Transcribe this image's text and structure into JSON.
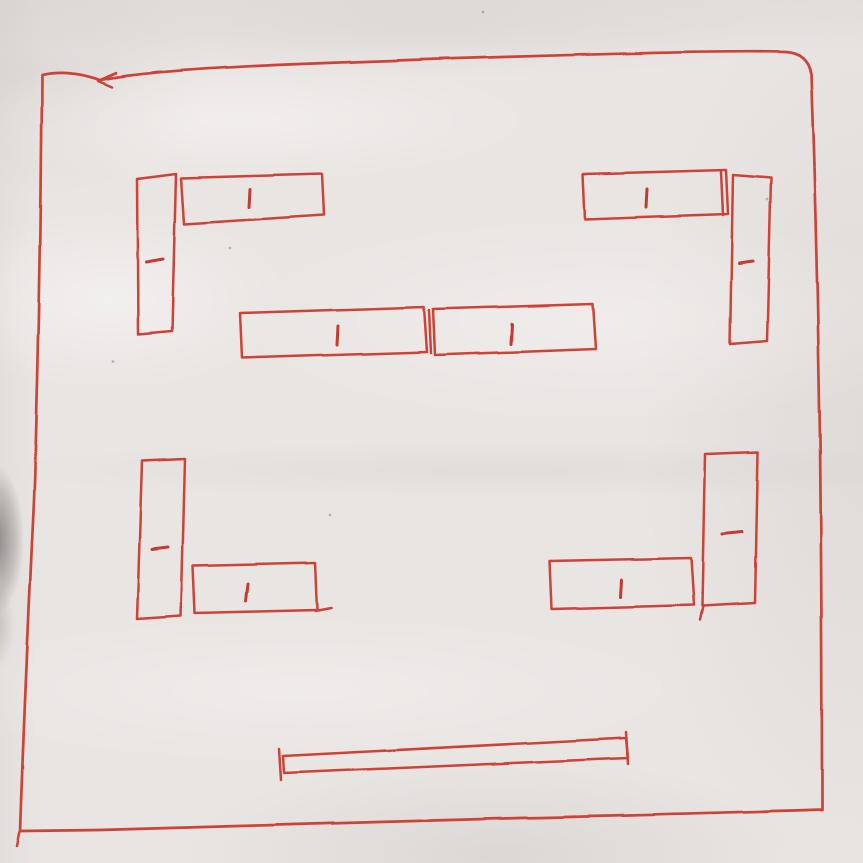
{
  "meta": {
    "description": "Photo of a hand-drawn red ink sketch on slightly crumpled white paper: a large square room outline containing ten small rectangular desk/table blocks (L-shaped pairs in each corner, two in the center) each with a short center tick mark, and one long thin bar near the bottom"
  },
  "palette": {
    "pen": "#cf4239",
    "pen_dark": "#c53b33",
    "paper": "#e9e5e3",
    "speck": "#8f8882",
    "edge_shadow": "#55504c"
  },
  "sketch": {
    "stroke_width": 2.5,
    "border_path": "M 42 75 Q 68 69 100 80 Q 150 70 300 64 Q 480 57 650 53 Q 740 51 785 52 Q 807 53 811 74 Q 817 240 820 440 Q 822 640 822 810 Q 700 814 520 818 Q 300 824 100 830 L 20 831 Q 25 690 34 500 Q 41 290 42 75",
    "shapes": [
      {
        "name": "desk-top-left-vertical",
        "points": [
          [
            137,
            179
          ],
          [
            176,
            174
          ],
          [
            172,
            331
          ],
          [
            138,
            334
          ]
        ],
        "tick": [
          [
            146,
            262
          ],
          [
            163,
            259
          ]
        ]
      },
      {
        "name": "desk-top-left-horizontal",
        "points": [
          [
            181,
            178
          ],
          [
            322,
            174
          ],
          [
            324,
            215
          ],
          [
            184,
            224
          ]
        ],
        "tick": [
          [
            250,
            189
          ],
          [
            249,
            207
          ]
        ]
      },
      {
        "name": "desk-center-left",
        "points": [
          [
            240,
            313
          ],
          [
            424,
            307
          ],
          [
            427,
            352
          ],
          [
            242,
            358
          ]
        ],
        "tick": [
          [
            338,
            326
          ],
          [
            337,
            345
          ]
        ]
      },
      {
        "name": "desk-center-right",
        "points": [
          [
            433,
            309
          ],
          [
            593,
            304
          ],
          [
            596,
            349
          ],
          [
            435,
            355
          ]
        ],
        "tick": [
          [
            512,
            324
          ],
          [
            511,
            344
          ]
        ]
      },
      {
        "name": "desk-top-right-horizontal",
        "points": [
          [
            583,
            174
          ],
          [
            726,
            170
          ],
          [
            728,
            214
          ],
          [
            585,
            219
          ]
        ],
        "tick": [
          [
            647,
            189
          ],
          [
            646,
            207
          ]
        ]
      },
      {
        "name": "desk-top-right-vertical",
        "points": [
          [
            733,
            175
          ],
          [
            771,
            178
          ],
          [
            767,
            341
          ],
          [
            730,
            344
          ]
        ],
        "tick": [
          [
            739,
            263
          ],
          [
            753,
            261
          ]
        ]
      },
      {
        "name": "desk-bottom-left-vertical",
        "points": [
          [
            142,
            461
          ],
          [
            185,
            459
          ],
          [
            181,
            616
          ],
          [
            137,
            619
          ]
        ],
        "tick": [
          [
            152,
            549
          ],
          [
            168,
            547
          ]
        ]
      },
      {
        "name": "desk-bottom-left-horizontal",
        "points": [
          [
            193,
            566
          ],
          [
            315,
            563
          ],
          [
            317,
            610
          ],
          [
            195,
            613
          ]
        ],
        "tick": [
          [
            248,
            584
          ],
          [
            246,
            601
          ]
        ]
      },
      {
        "name": "desk-bottom-right-horizontal",
        "points": [
          [
            549,
            561
          ],
          [
            691,
            558
          ],
          [
            694,
            605
          ],
          [
            551,
            609
          ]
        ],
        "tick": [
          [
            622,
            580
          ],
          [
            621,
            597
          ]
        ]
      },
      {
        "name": "desk-bottom-right-vertical",
        "points": [
          [
            705,
            454
          ],
          [
            758,
            452
          ],
          [
            755,
            603
          ],
          [
            702,
            606
          ]
        ],
        "tick": [
          [
            722,
            534
          ],
          [
            742,
            532
          ]
        ]
      },
      {
        "name": "bottom-bar",
        "points": [
          [
            283,
            756
          ],
          [
            626,
            738
          ],
          [
            628,
            758
          ],
          [
            284,
            773
          ]
        ]
      }
    ],
    "marks": [
      {
        "name": "pen-hook-top-edge",
        "points": [
          [
            116,
            73
          ],
          [
            98,
            81
          ],
          [
            112,
            87
          ]
        ]
      },
      {
        "name": "corner-tail-bottom-left",
        "points": [
          [
            20,
            831
          ],
          [
            17,
            846
          ]
        ]
      },
      {
        "name": "bar-left-serif",
        "points": [
          [
            279,
            749
          ],
          [
            281,
            780
          ]
        ]
      },
      {
        "name": "bar-right-serif",
        "points": [
          [
            626,
            732
          ],
          [
            628,
            764
          ]
        ]
      },
      {
        "name": "double-edge-center-right",
        "points": [
          [
            429,
            310
          ],
          [
            431,
            353
          ]
        ]
      },
      {
        "name": "double-edge-top-right-desk",
        "points": [
          [
            721,
            172
          ],
          [
            723,
            215
          ]
        ]
      },
      {
        "name": "overshoot-bottom-left-desk",
        "points": [
          [
            315,
            611
          ],
          [
            331,
            608
          ]
        ]
      },
      {
        "name": "tail-bottom-right-vertical",
        "points": [
          [
            703,
            606
          ],
          [
            700,
            620
          ]
        ]
      }
    ],
    "specks": [
      [
        483,
        12
      ],
      [
        113,
        361
      ],
      [
        767,
        200
      ],
      [
        230,
        248
      ],
      [
        330,
        515
      ]
    ]
  }
}
